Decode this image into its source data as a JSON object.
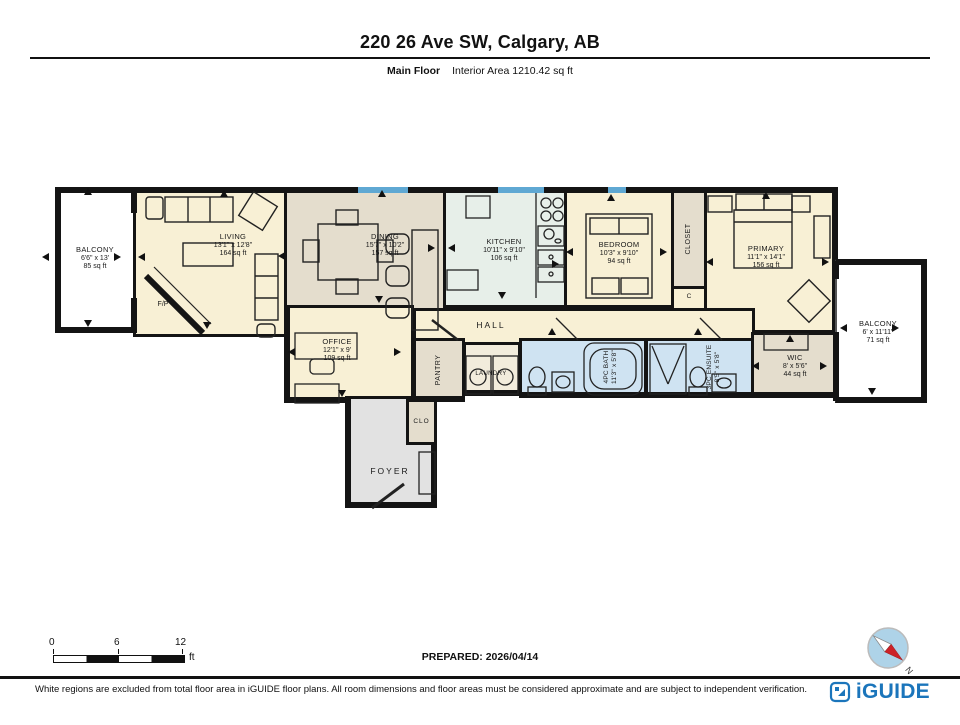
{
  "header": {
    "title": "220 26 Ave SW, Calgary, AB",
    "floor_label": "Main Floor",
    "area_label": "Interior Area 1210.42 sq ft"
  },
  "rooms": {
    "balcony_left": {
      "name": "BALCONY",
      "dims": "6'6\" x 13'",
      "area": "85 sq ft"
    },
    "living": {
      "name": "LIVING",
      "dims": "13'1\" x 12'8\"",
      "area": "164 sq ft"
    },
    "fireplace": {
      "name": "F/P"
    },
    "dining": {
      "name": "DINING",
      "dims": "15'7\" x 10'2\"",
      "area": "157 sq ft"
    },
    "kitchen": {
      "name": "KITCHEN",
      "dims": "10'11\" x 9'10\"",
      "area": "106 sq ft"
    },
    "bedroom": {
      "name": "BEDROOM",
      "dims": "10'3\" x 9'10\"",
      "area": "94 sq ft"
    },
    "closet": {
      "name": "CLOSET"
    },
    "closet_c": {
      "name": "C"
    },
    "primary": {
      "name": "PRIMARY",
      "dims": "11'1\" x 14'1\"",
      "area": "156 sq ft"
    },
    "balcony_right": {
      "name": "BALCONY",
      "dims": "6' x 11'11\"",
      "area": "71 sq ft"
    },
    "wic": {
      "name": "WIC",
      "dims": "8' x 5'6\"",
      "area": "44 sq ft"
    },
    "hall": {
      "name": "HALL"
    },
    "office": {
      "name": "OFFICE",
      "dims": "12'1\" x 9'",
      "area": "109 sq ft"
    },
    "pantry": {
      "name": "PANTRY"
    },
    "laundry": {
      "name": "LAUNDRY"
    },
    "bath": {
      "name": "4PC BATH",
      "dims": "11'3\" x 5'8\""
    },
    "ensuite": {
      "name": "3PC ENSUITE",
      "dims": "8'5\" x 5'8\""
    },
    "foyer": {
      "name": "FOYER"
    },
    "clo": {
      "name": "CLO"
    }
  },
  "scale": {
    "ticks": [
      "0",
      "6",
      "12"
    ],
    "unit": "ft"
  },
  "prepared_label": "PREPARED: 2026/04/14",
  "compass": {
    "north": "N"
  },
  "footer": {
    "disclaimer": "White regions are excluded from total floor area in iGUIDE floor plans. All room dimensions and floor areas must be considered approximate and are subject to independent verification.",
    "brand": "iGUIDE"
  },
  "colors": {
    "cream": "#f8f0d5",
    "taupe": "#e4ddcd",
    "kitchen_green": "#e7efe9",
    "bath_blue": "#cfe3f2",
    "foyer_gray": "#e2e2e2",
    "window_blue": "#5fa8d3",
    "wall": "#141414",
    "brand_blue": "#1b75bb"
  }
}
